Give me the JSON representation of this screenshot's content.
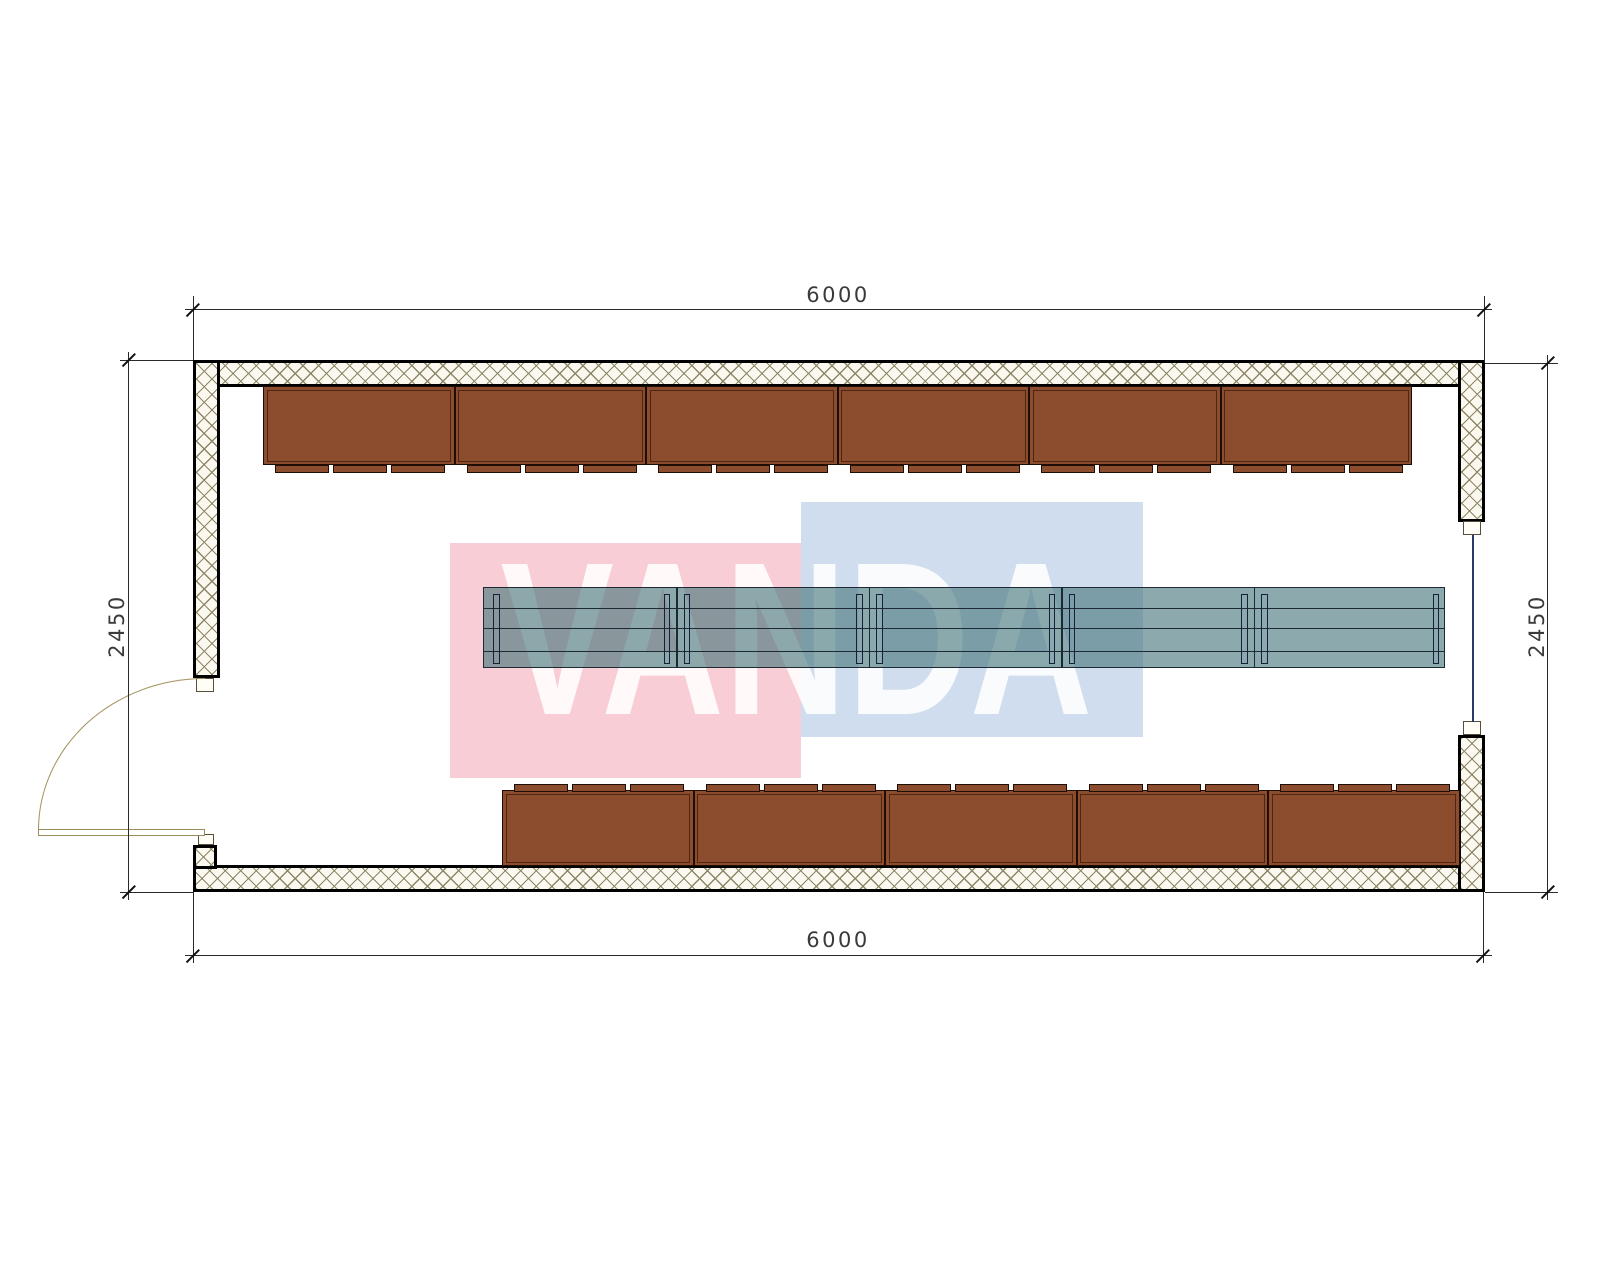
{
  "watermark": {
    "text": "VANDA",
    "pink_color": "#f8cdd6",
    "blue_color": "#cfddee"
  },
  "dimensions": {
    "top": "6000",
    "bottom": "6000",
    "left": "2450",
    "right": "2450"
  },
  "furniture": {
    "top_cabinet_count": 6,
    "bottom_cabinet_count": 5,
    "cabinet_color": "#8b4d2e",
    "table_segment_count": 5,
    "table_fill": "rgba(70,118,122,0.62)"
  },
  "colors": {
    "wall_hatch_line": "#8d8666",
    "window_line": "#2c3a6b",
    "door_line": "#a3905c"
  }
}
